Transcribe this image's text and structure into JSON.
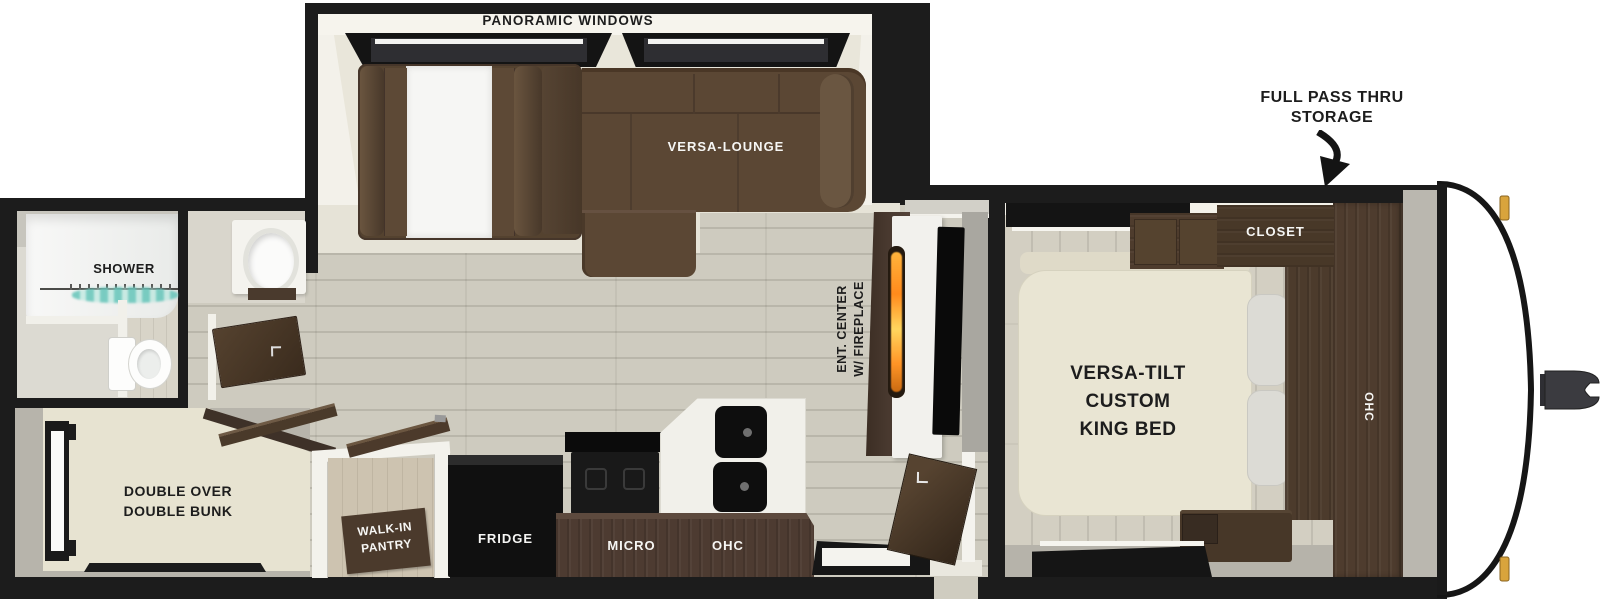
{
  "fp": {
    "slideout": {
      "windows_label": "PANORAMIC WINDOWS",
      "lounge_label": "VERSA-LOUNGE"
    },
    "storage": {
      "line1": "FULL PASS THRU",
      "line2": "STORAGE"
    },
    "bedroom": {
      "closet": "CLOSET",
      "ohc": "OHC",
      "bed1": "VERSA-TILT",
      "bed2": "CUSTOM",
      "bed3": "KING BED"
    },
    "living": {
      "ent1": "ENT. CENTER",
      "ent2": "W/ FIREPLACE"
    },
    "bath": {
      "shower": "SHOWER"
    },
    "bunk": {
      "line1": "DOUBLE OVER",
      "line2": "DOUBLE BUNK"
    },
    "kitchen": {
      "pantry1": "WALK-IN",
      "pantry2": "PANTRY",
      "fridge": "FRIDGE",
      "micro": "MICRO",
      "ohc": "OHC"
    }
  },
  "colors": {
    "wall": "#1c1c1c",
    "floor_wood": "#cecbbf",
    "sofa_brown": "#5b4734",
    "cabinet_brown": "#4a392f",
    "mattress_cream": "#e9e5d3",
    "counter_white": "#f1f0ea",
    "appliance_black": "#121212",
    "curtain_teal": "#7ccabe",
    "flame_orange": "#ff9a26",
    "marker_amber": "#d9a43c"
  }
}
